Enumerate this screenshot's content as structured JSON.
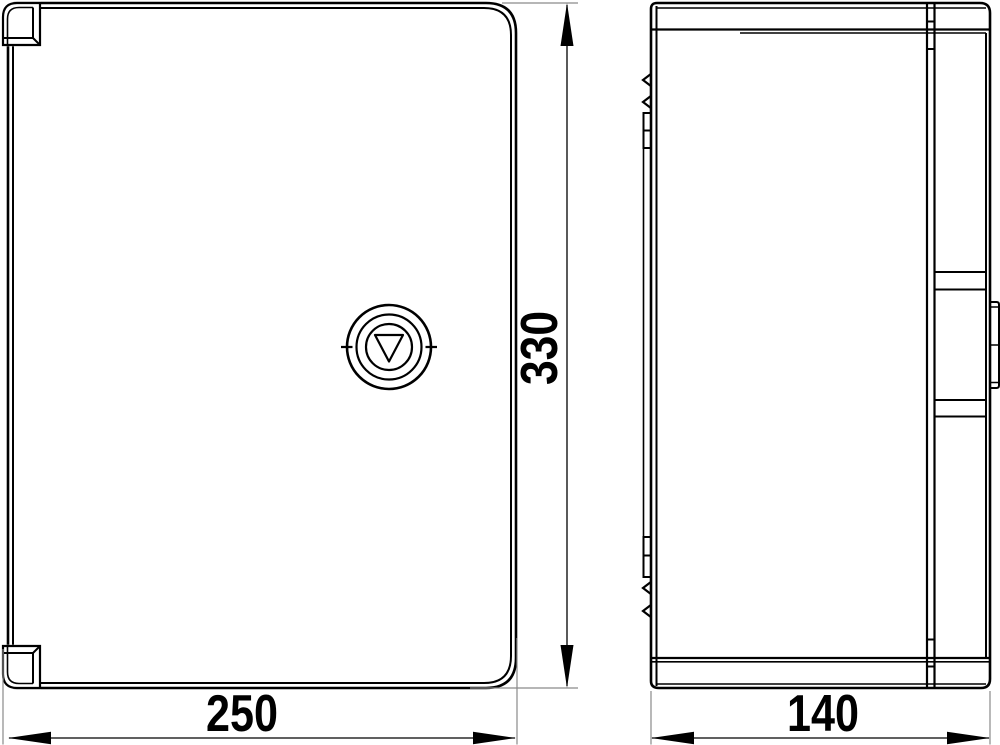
{
  "drawing": {
    "dimension_labels": {
      "front_width": "250",
      "front_height": "330",
      "side_depth": "140"
    },
    "colors": {
      "line": "#000000",
      "extension_line": "#8a8a8a",
      "background": "#ffffff"
    }
  }
}
